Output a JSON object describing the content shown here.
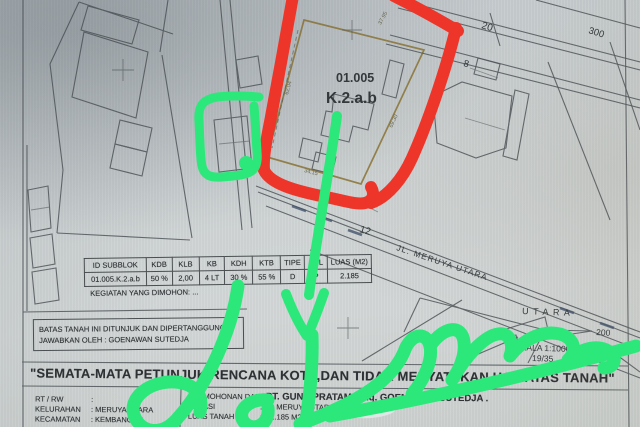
{
  "photo": {
    "map": {
      "plot_id": "01.005",
      "plot_class": "K.2.a.b",
      "street": "JL. MERUYA UTARA",
      "north": "UTARA",
      "scale": "SKALA  1:1000",
      "sheet": "19/35",
      "house_numbers": {
        "h20": "20",
        "h300": "300",
        "h8": "8",
        "h12": "12",
        "h6": "6",
        "h200": "200"
      },
      "dimensions": {
        "left": "62.04",
        "top": "37.95",
        "right": "69.30",
        "bottom": "34.15"
      }
    },
    "zoning_table": {
      "headers": [
        "ID SUBBLOK",
        "KDB",
        "KLB",
        "KB",
        "KDH",
        "KTB",
        "TIPE",
        "PSL",
        "LUAS (M2)"
      ],
      "row": [
        "01.005.K.2.a.b",
        "50 %",
        "2,00",
        "4 LT",
        "30 %",
        "55 %",
        "D",
        "P",
        "2.185"
      ],
      "footer": "KEGIATAN YANG DIMOHON: ..."
    },
    "attestation": {
      "line1": "BATAS TANAH INI DITUNJUK DAN DIPERTANGGUNG",
      "line2": "JAWABKAN OLEH : GOENAWAN SUTEDJA"
    },
    "disclaimer": "\"SEMATA-MATA PETUNJUK RENCANA KOTA,DAN TIDAK MENYATAKAN HAK ATAS TANAH\"",
    "info": {
      "left": [
        {
          "label": "RT / RW",
          "value": ":"
        },
        {
          "label": "KELURAHAN",
          "value": ":  MERUYA UTARA"
        },
        {
          "label": "KECAMATAN",
          "value": ":  KEMBANGAN"
        }
      ],
      "right": [
        {
          "label": "PERMOHONAN DARI",
          "value": ":  PT. GUNA PRATAMA c.q. GOENAWAN SUTEDJA ."
        },
        {
          "label": "LOKASI",
          "value": ":  JL. MERUYA UTARA"
        },
        {
          "label": "LUAS TANAH",
          "value": ":  ± 2.185 M2"
        }
      ]
    },
    "annotation_colors": {
      "red_marker": "#ee3529",
      "green_marker": "#2ce87b"
    }
  }
}
